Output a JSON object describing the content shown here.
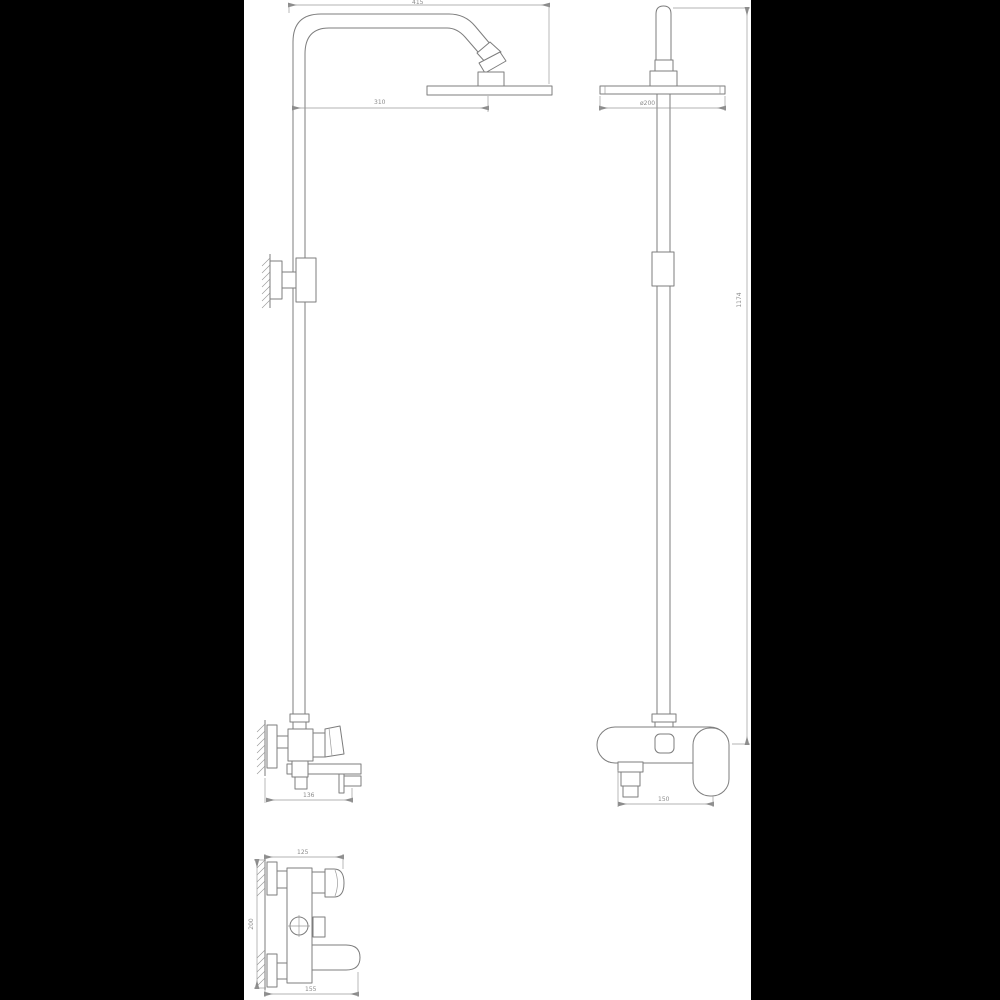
{
  "colors": {
    "background": "#000000",
    "paper": "#ffffff",
    "line": "#7d7d7d",
    "dim_text": "#8c8c8c"
  },
  "dims": {
    "arm_length": "415",
    "arm_reach": "310",
    "head_diameter": "ø200",
    "overall_height": "1174",
    "mixer_depth": "136",
    "mixer_width": "150",
    "detail_depth": "125",
    "detail_height": "200",
    "detail_width": "155"
  }
}
